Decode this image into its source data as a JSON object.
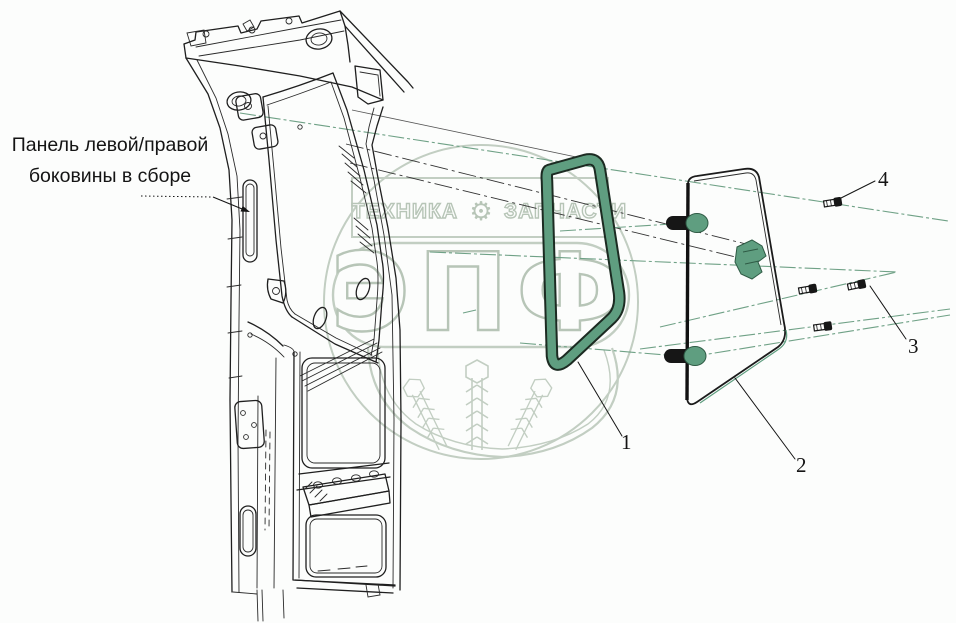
{
  "page": {
    "width": 956,
    "height": 623,
    "background": "#fcfdfc"
  },
  "part_label": {
    "line1": "Панель левой/правой",
    "line2": "боковины в сборе"
  },
  "callouts": {
    "n1": "1",
    "n2": "2",
    "n3": "3",
    "n4": "4"
  },
  "watermark": {
    "banner_left": "ТЕХНИКА",
    "banner_right": "ЗАПЧАСТИ",
    "gear_icon": "⚙",
    "monogram": "ЭПФ"
  },
  "colors": {
    "drawing_line": "#1f1f1f",
    "seal_green": "#5f9e80",
    "hardware_green": "#5f9e80",
    "centerline_green": "#6fa186",
    "watermark_sage": "#b7c5b7",
    "callout_ink": "#141414"
  }
}
